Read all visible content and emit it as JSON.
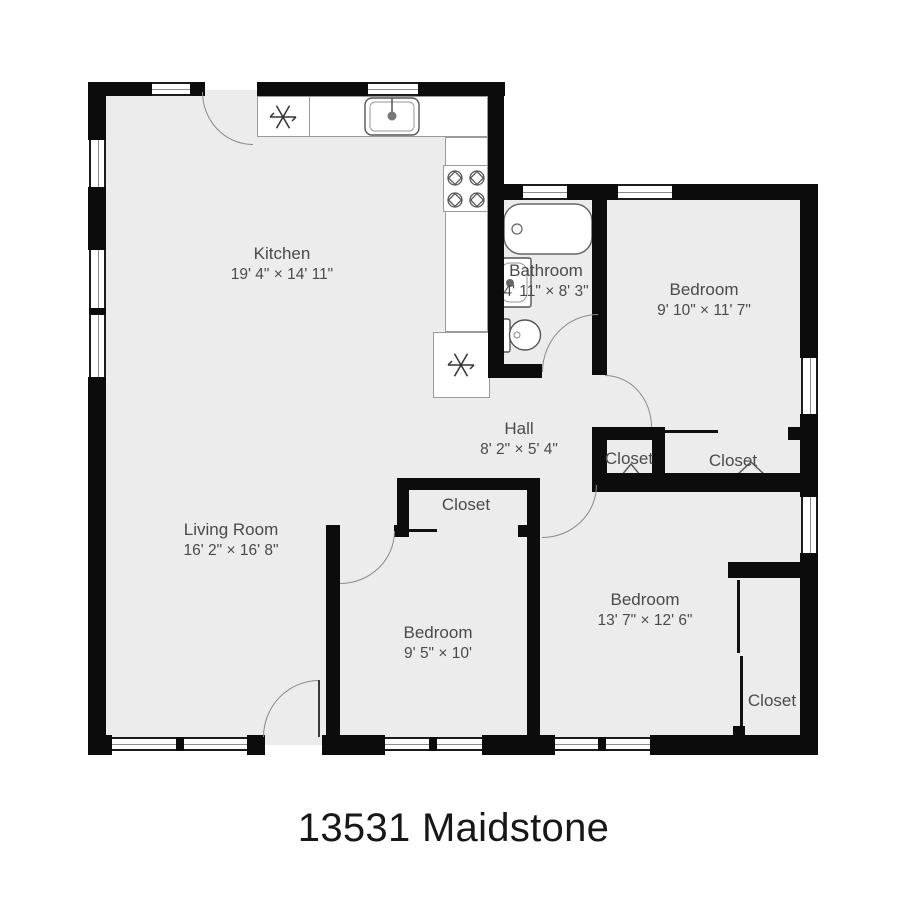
{
  "title": "13531 Maidstone",
  "rooms": {
    "kitchen": {
      "name": "Kitchen",
      "dims": "19' 4\" × 14' 11\""
    },
    "living_room": {
      "name": "Living Room",
      "dims": "16' 2\" × 16' 8\""
    },
    "hall": {
      "name": "Hall",
      "dims": "8' 2\" × 5' 4\""
    },
    "bathroom": {
      "name": "Bathroom",
      "dims": "4' 11\" × 8' 3\""
    },
    "bedroom_top_right": {
      "name": "Bedroom",
      "dims": "9' 10\" × 11' 7\""
    },
    "bedroom_middle": {
      "name": "Bedroom",
      "dims": "9' 5\" × 10'"
    },
    "bedroom_bottom_right": {
      "name": "Bedroom",
      "dims": "13' 7\" × 12' 6\""
    },
    "closet_hall": {
      "name": "Closet"
    },
    "closet_top_right": {
      "name": "Closet"
    },
    "closet_middle": {
      "name": "Closet"
    },
    "closet_bottom_right": {
      "name": "Closet"
    }
  },
  "colors": {
    "wall": "#0c0c0c",
    "floor": "#ececec",
    "label": "#4a4a4a",
    "arc": "#8a8a8a",
    "fixture": "#666666"
  }
}
